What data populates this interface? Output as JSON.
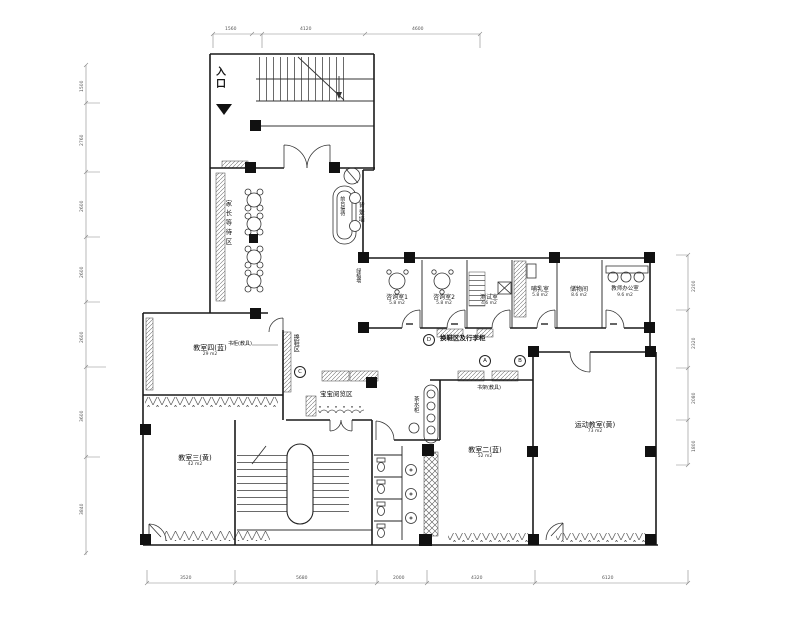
{
  "labels": {
    "entrance": "入口",
    "waiting_area": "家长等待区",
    "front_desk": "前台接待",
    "background_wall": "背景墙",
    "plant_wall": "绿植墙",
    "shoe_area": "换鞋区",
    "bookcase": "书柜(教具)",
    "shoe_luggage": "换鞋区及行李柜",
    "baby_reading": "宝宝阅览区",
    "tea_cabinet": "茶水柜",
    "bookshelf": "书架(教具)"
  },
  "rooms": [
    {
      "name": "咨询室1",
      "area": "5.8 m2"
    },
    {
      "name": "咨询室2",
      "area": "5.8 m2"
    },
    {
      "name": "测试室",
      "area": "4.6 m2"
    },
    {
      "name": "哺乳室",
      "area": "5.8 m2"
    },
    {
      "name": "储物间",
      "area": "8.6 m2"
    },
    {
      "name": "教师办公室",
      "area": "9.6 m2"
    },
    {
      "name": "教室四(蓝)",
      "area": "29 m2"
    },
    {
      "name": "教室三(黄)",
      "area": "42 m2"
    },
    {
      "name": "教室二(蓝)",
      "area": "52 m2"
    },
    {
      "name": "运动教室(黄)",
      "area": "73 m2"
    }
  ],
  "markers": {
    "a": "A",
    "b": "B",
    "c": "C",
    "d": "D"
  },
  "dimensions": {
    "top": [
      "1560",
      "4120",
      "4600"
    ],
    "bottom": [
      "3520",
      "5680",
      "2000",
      "4320",
      "6120"
    ],
    "left": [
      "1500",
      "2760",
      "2600",
      "2600",
      "2600",
      "3600",
      "3840"
    ],
    "right": [
      "2200",
      "2320",
      "2080",
      "1800"
    ]
  }
}
